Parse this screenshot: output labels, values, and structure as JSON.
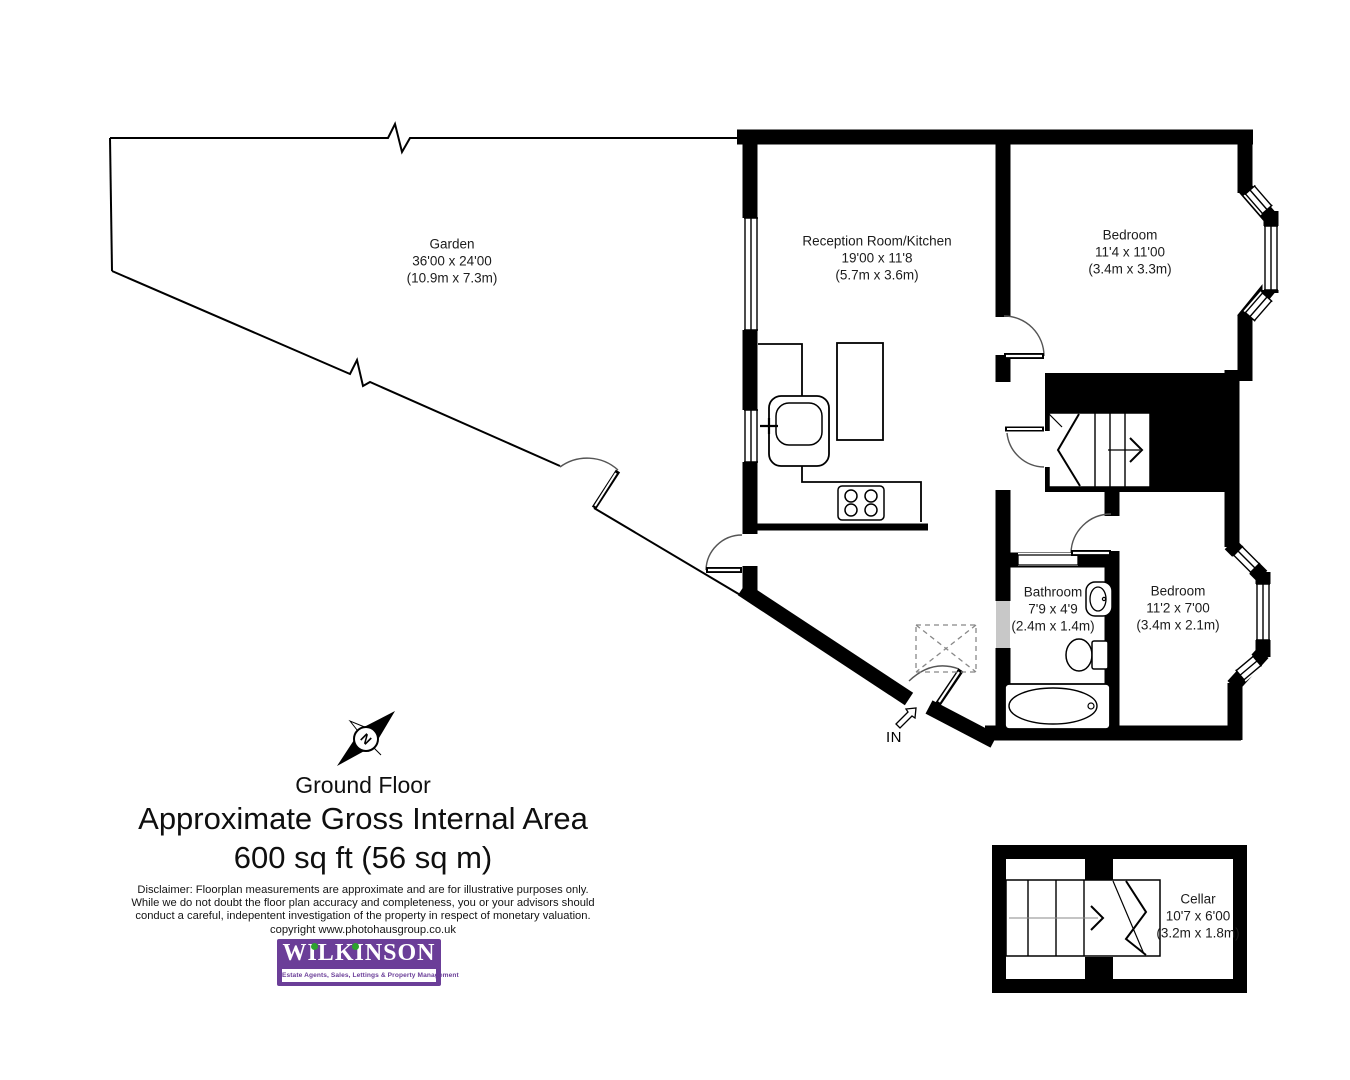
{
  "title_block": {
    "floor": "Ground Floor",
    "area_heading": "Approximate Gross Internal Area",
    "area_value": "600 sq ft (56 sq m)"
  },
  "rooms": [
    {
      "id": "garden",
      "name": "Garden",
      "dims_ft": "36'00 x 24'00",
      "dims_m": "(10.9m x 7.3m)"
    },
    {
      "id": "reception",
      "name": "Reception Room/Kitchen",
      "dims_ft": "19'00 x 11'8",
      "dims_m": "(5.7m x 3.6m)"
    },
    {
      "id": "bedroom1",
      "name": "Bedroom",
      "dims_ft": "11'4 x 11'00",
      "dims_m": "(3.4m x 3.3m)"
    },
    {
      "id": "bathroom",
      "name": "Bathroom",
      "dims_ft": "7'9 x 4'9",
      "dims_m": "(2.4m x 1.4m)"
    },
    {
      "id": "bedroom2",
      "name": "Bedroom",
      "dims_ft": "11'2 x 7'00",
      "dims_m": "(3.4m x 2.1m)"
    },
    {
      "id": "cellar",
      "name": "Cellar",
      "dims_ft": "10'7 x 6'00",
      "dims_m": "(3.2m x 1.8m)"
    }
  ],
  "entrance": {
    "label": "IN"
  },
  "compass": {
    "label": "N"
  },
  "disclaimer": {
    "line1": "Disclaimer: Floorplan measurements are approximate and are for illustrative purposes only.",
    "line2": "While we do not doubt the floor plan accuracy and completeness, you or your advisors should",
    "line3": "conduct a careful, indepentent investigation of the property in respect of monetary valuation.",
    "line4": "copyright www.photohausgroup.co.uk"
  },
  "logo": {
    "name": "WILKINSON",
    "tagline": "Estate Agents, Sales, Lettings & Property Management",
    "brand_color": "#6b3e98",
    "dot_color": "#2da12e"
  },
  "colors": {
    "wall": "#000000",
    "window_gray": "#c8c8c8"
  }
}
